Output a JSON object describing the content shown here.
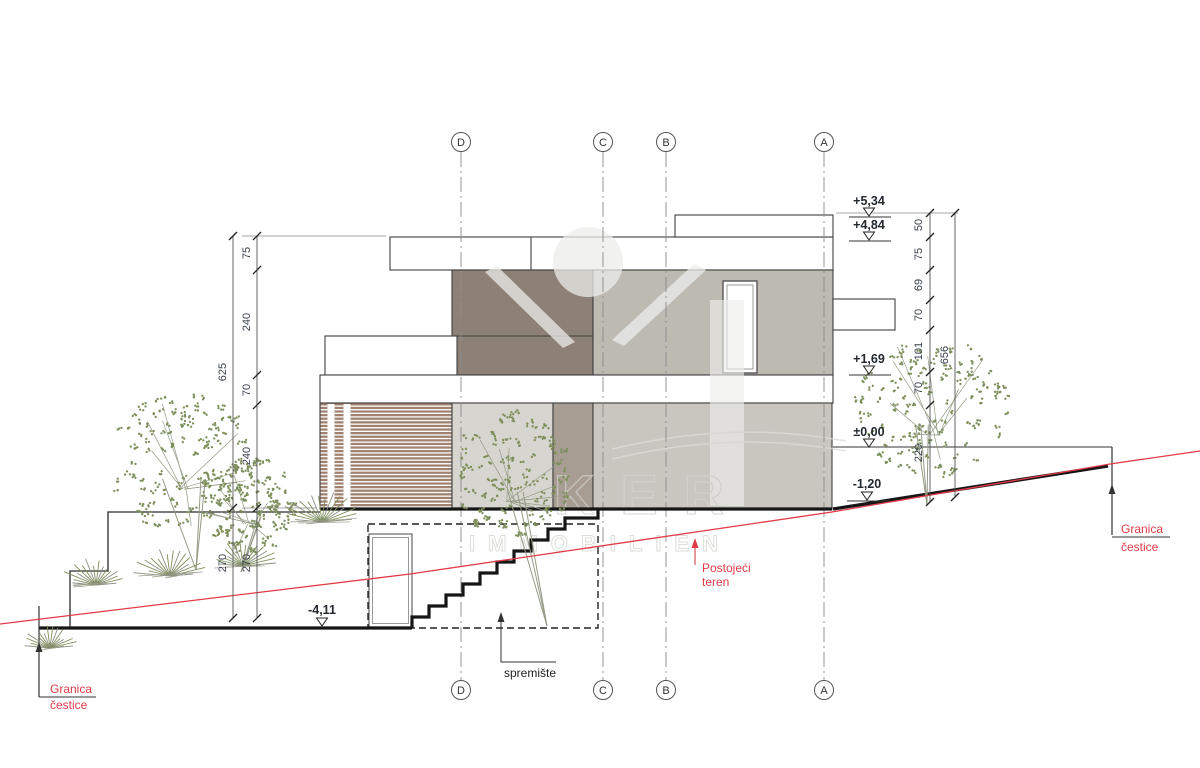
{
  "grid": {
    "letters": [
      "D",
      "C",
      "B",
      "A"
    ]
  },
  "dimensions": {
    "left": {
      "overall": "625",
      "overall_lower": "270",
      "chain": [
        "75",
        "240",
        "70",
        "240",
        "270"
      ]
    },
    "right": {
      "overall": "656",
      "chain": [
        "50",
        "75",
        "69",
        "70",
        "101",
        "70",
        "220"
      ]
    }
  },
  "elevations": {
    "e534": "+5,34",
    "e484": "+4,84",
    "e169": "+1,69",
    "e000": "±0,00",
    "em120": "-1,20",
    "em411": "-4,11"
  },
  "labels": {
    "granica_line1": "Granica",
    "granica_line2": "čestice",
    "postojeci_line1": "Postojeći",
    "postojeci_line2": "teren",
    "spremiste": "spremište"
  },
  "watermark": {
    "line1": "KER",
    "line2": "IMMOBILIEN"
  },
  "colors": {
    "label_red": "#e23b47",
    "terrain_red": "#e23b47",
    "wall_dark": "#8d8177",
    "wall_light": "#bdbab2",
    "ground_main": "#c9c6c0",
    "ground_light": "#d7d5cf",
    "ground_mid": "#a79d93",
    "slat": "#a08270",
    "foliage": "#7d8f5a",
    "branch": "#939a84"
  },
  "vegetation": {
    "trees": [
      {
        "cx": 182,
        "cy": 462,
        "rx": 74,
        "ry": 68,
        "base_x": 196,
        "base_y": 570,
        "seed": 7
      },
      {
        "cx": 249,
        "cy": 505,
        "rx": 46,
        "ry": 48,
        "base_x": 241,
        "base_y": 572,
        "seed": 19
      },
      {
        "cx": 512,
        "cy": 476,
        "rx": 60,
        "ry": 64,
        "base_x": 547,
        "base_y": 626,
        "seed": 31
      },
      {
        "cx": 934,
        "cy": 407,
        "rx": 77,
        "ry": 70,
        "base_x": 927,
        "base_y": 505,
        "seed": 43
      }
    ],
    "tufts": [
      {
        "x": 96,
        "y": 585,
        "s": 1.0,
        "seed": 3
      },
      {
        "x": 170,
        "y": 576,
        "s": 1.1,
        "seed": 5
      },
      {
        "x": 243,
        "y": 566,
        "s": 1.0,
        "seed": 9
      },
      {
        "x": 322,
        "y": 522,
        "s": 1.25,
        "seed": 11
      },
      {
        "x": 50,
        "y": 648,
        "s": 0.8,
        "seed": 13
      }
    ]
  }
}
